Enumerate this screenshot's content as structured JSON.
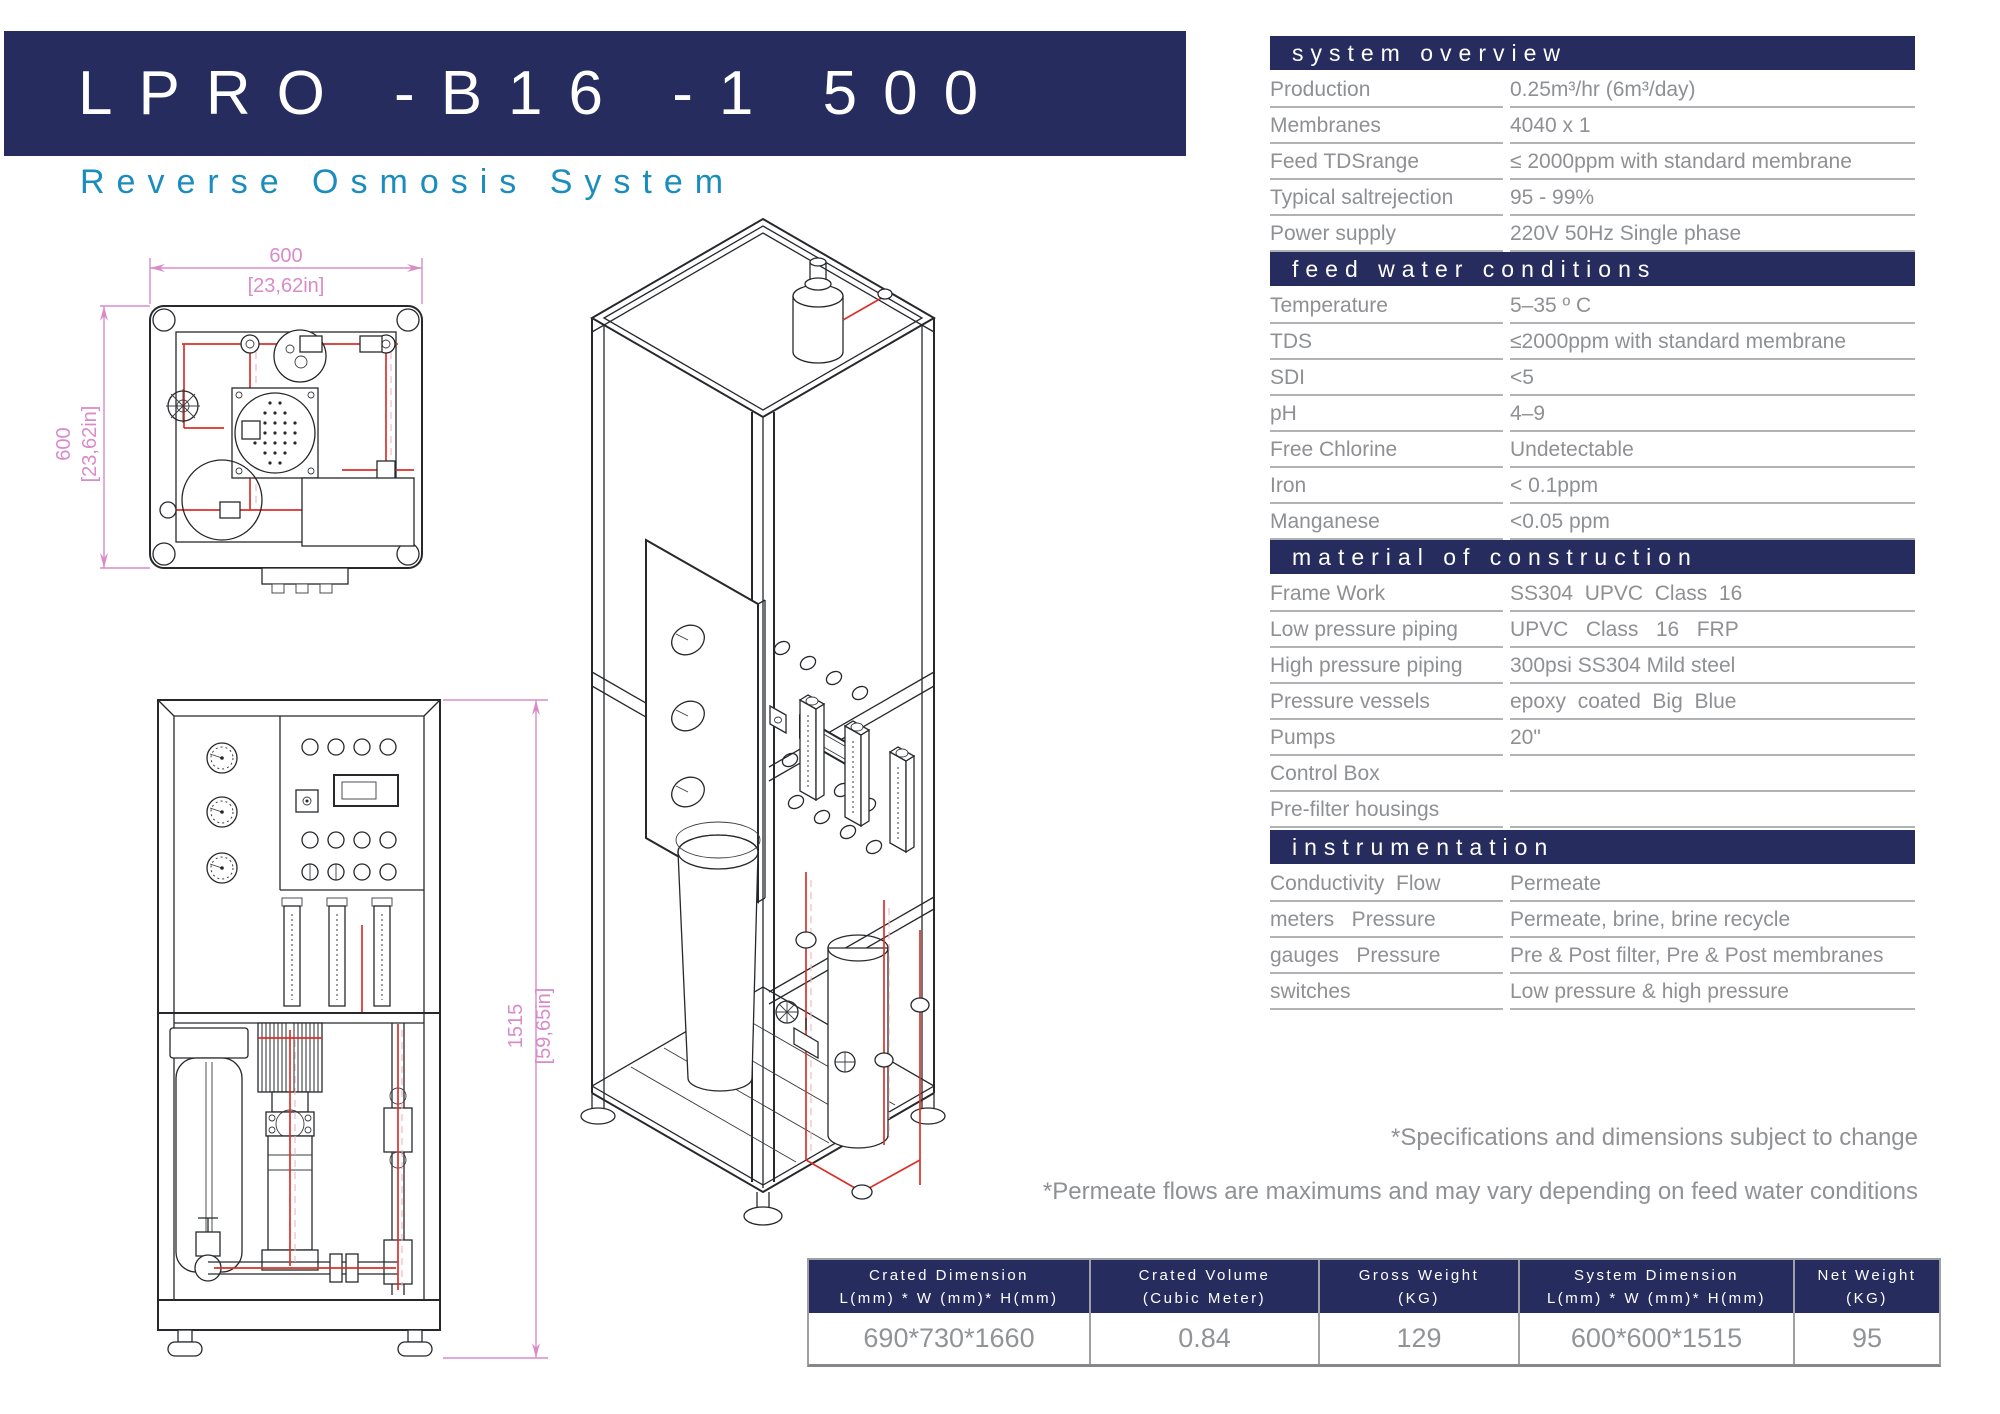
{
  "header": {
    "title": "LPRO -B16 -1 500",
    "subtitle": "Reverse Osmosis System"
  },
  "colors": {
    "navy": "#262c5d",
    "teal": "#1b8dbd",
    "spec_gray": "#8e9093",
    "dimension_pink": "#d98bc9",
    "pipe_red": "#d93129"
  },
  "sections": [
    {
      "title": "system overview",
      "rows": [
        {
          "label": "Production",
          "value": "0.25m³/hr (6m³/day)"
        },
        {
          "label": "Membranes",
          "value": "4040 x 1"
        },
        {
          "label": "Feed TDSrange",
          "value": "≤ 2000ppm with standard membrane"
        },
        {
          "label": "Typical saltrejection",
          "value": "95 - 99%"
        },
        {
          "label": "Power supply",
          "value": "220V 50Hz Single phase"
        }
      ]
    },
    {
      "title": "feed water conditions",
      "rows": [
        {
          "label": "Temperature",
          "value": "5–35 º C"
        },
        {
          "label": "TDS",
          "value": "≤2000ppm with standard membrane"
        },
        {
          "label": "SDI",
          "value": "<5"
        },
        {
          "label": "pH",
          "value": "4–9"
        },
        {
          "label": "Free Chlorine",
          "value": "Undetectable"
        },
        {
          "label": "Iron",
          "value": "< 0.1ppm"
        },
        {
          "label": "Manganese",
          "value": "<0.05 ppm"
        }
      ]
    },
    {
      "title": "material of construction",
      "rows": [
        {
          "label": "Frame Work",
          "value": "SS304  UPVC  Class  16"
        },
        {
          "label": "Low pressure piping",
          "value": "UPVC   Class   16   FRP"
        },
        {
          "label": "High pressure piping",
          "value": "300psi SS304 Mild steel"
        },
        {
          "label": "Pressure vessels",
          "value": "epoxy  coated  Big  Blue"
        },
        {
          "label": "Pumps",
          "value": "20\""
        },
        {
          "label": "Control Box",
          "value": ""
        },
        {
          "label": "Pre-filter housings",
          "value": ""
        }
      ]
    },
    {
      "title": "instrumentation",
      "rows": [
        {
          "label": "Conductivity  Flow",
          "value": "Permeate"
        },
        {
          "label": "meters   Pressure",
          "value": "Permeate, brine, brine recycle"
        },
        {
          "label": "gauges   Pressure",
          "value": "Pre & Post filter, Pre & Post membranes"
        },
        {
          "label": "switches",
          "value": "Low pressure & high pressure"
        }
      ]
    }
  ],
  "notes": [
    "*Specifications and dimensions subject to change",
    "*Permeate flows are maximums and may vary depending on feed water conditions"
  ],
  "shipping_table": {
    "columns": [
      {
        "title": "Crated Dimension",
        "subtitle": "L(mm) * W (mm)* H(mm)",
        "value": "690*730*1660"
      },
      {
        "title": "Crated Volume",
        "subtitle": "(Cubic Meter)",
        "value": "0.84"
      },
      {
        "title": "Gross Weight",
        "subtitle": "(KG)",
        "value": "129"
      },
      {
        "title": "System Dimension",
        "subtitle": "L(mm) * W (mm)* H(mm)",
        "value": "600*600*1515"
      },
      {
        "title": "Net Weight",
        "subtitle": "(KG)",
        "value": "95"
      }
    ]
  },
  "drawings": {
    "top_view": {
      "width_mm": "600",
      "width_in": "[23,62in]",
      "depth_mm": "600",
      "depth_in": "[23,62in]"
    },
    "front_view": {
      "height_mm": "1515",
      "height_in": "[59,65in]"
    }
  }
}
